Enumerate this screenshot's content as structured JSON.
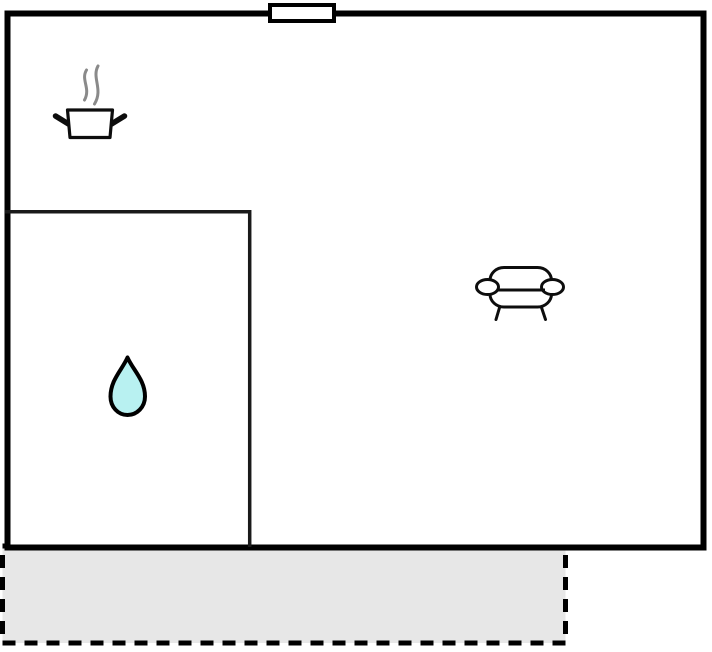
{
  "canvas": {
    "width": 712,
    "height": 652,
    "background": "#ffffff"
  },
  "floorplan": {
    "type": "holiday-home floor plan, no text labels",
    "wall_color": "#000000",
    "room_fill": "#ffffff",
    "inner_room_wall_color": "#1a1a1a",
    "window": {
      "fill": "#ffffff",
      "frame_color": "#000000"
    },
    "terrace": {
      "fill": "#e7e7e7",
      "border_color": "#000000",
      "border_style": "dashed"
    },
    "icons": {
      "kitchen": {
        "name": "cooking-pot-icon",
        "pot_fill": "#ffffff",
        "pot_stroke": "#0d0d0d",
        "steam_color": "#8a8a8a"
      },
      "bathroom": {
        "name": "water-drop-icon",
        "fill": "#b8f1f1",
        "stroke": "#000000"
      },
      "living_room": {
        "name": "sofa-icon",
        "fill": "#ffffff",
        "stroke": "#0d0d0d"
      }
    }
  }
}
